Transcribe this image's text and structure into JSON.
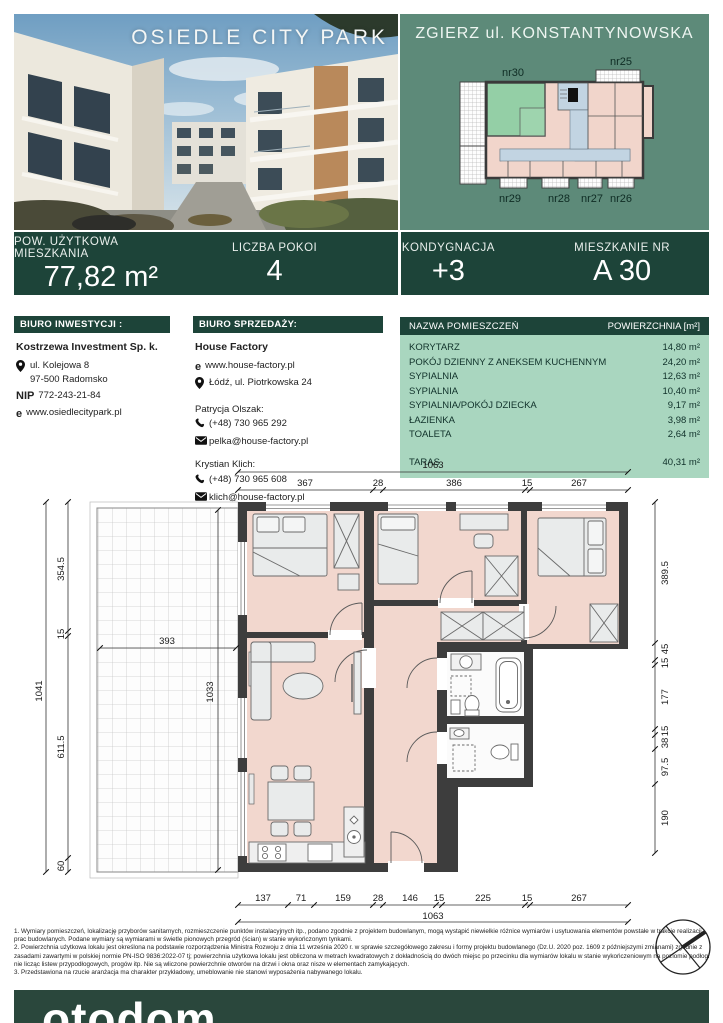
{
  "photo": {
    "title": "OSIEDLE CITY PARK"
  },
  "location": {
    "title": "ZGIERZ ul. KONSTANTYNOWSKA",
    "units": {
      "top_left": "nr30",
      "top_right": "nr25",
      "bottom": [
        "nr29",
        "nr28",
        "nr27",
        "nr26"
      ]
    }
  },
  "summary": {
    "cells": [
      {
        "label": "POW. UŻYTKOWA MIESZKANIA",
        "value": "77,82 m²"
      },
      {
        "label": "LICZBA POKOI",
        "value": "4"
      },
      {
        "label": "KONDYGNACJA",
        "value": "+3"
      },
      {
        "label": "MIESZKANIE NR",
        "value": "A 30"
      }
    ]
  },
  "investment_office": {
    "header": "BIURO INWESTYCJI :",
    "company": "Kostrzewa Investment Sp. k.",
    "address_line1": "ul. Kolejowa 8",
    "address_line2": "97-500 Radomsko",
    "nip_label": "NIP",
    "nip_value": "772-243-21-84",
    "web_prefix": "e",
    "website": "www.osiedlecitypark.pl"
  },
  "sales_office": {
    "header": "BIURO SPRZEDAŻY:",
    "company": "House Factory",
    "web_prefix": "e",
    "website": "www.house-factory.pl",
    "address": "Łódź, ul. Piotrkowska 24",
    "agents": [
      {
        "name": "Patrycja Olszak:",
        "phone": "(+48) 730 965 292",
        "email": "pelka@house-factory.pl"
      },
      {
        "name": "Krystian Klich:",
        "phone": "(+48) 730 965 608",
        "email": "klich@house-factory.pl"
      }
    ]
  },
  "rooms_table": {
    "header_name": "NAZWA POMIESZCZEŃ",
    "header_area": "POWIERZCHNIA [m²]",
    "rows": [
      {
        "name": "KORYTARZ",
        "area": "14,80 m²"
      },
      {
        "name": "POKÓJ DZIENNY Z ANEKSEM KUCHENNYM",
        "area": "24,20 m²"
      },
      {
        "name": "SYPIALNIA",
        "area": "12,63 m²"
      },
      {
        "name": "SYPIALNIA",
        "area": "10,40 m²"
      },
      {
        "name": "SYPIALNIA/POKÓJ DZIECKA",
        "area": "9,17 m²"
      },
      {
        "name": "ŁAZIENKA",
        "area": "3,98 m²"
      },
      {
        "name": "TOALETA",
        "area": "2,64 m²"
      }
    ],
    "taras": {
      "name": "TARAS",
      "area": "40,31 m²"
    }
  },
  "plan": {
    "dims": {
      "top_total": "1063",
      "top": [
        "367",
        "28",
        "386",
        "15",
        "267"
      ],
      "bottom": [
        "137",
        "71",
        "159",
        "28",
        "146",
        "15",
        "225",
        "15",
        "267"
      ],
      "bottom_total": "1063",
      "left_total": "1041",
      "left": [
        "354.5",
        "15",
        "611.5",
        "60"
      ],
      "right": [
        "389.5",
        "45",
        "15",
        "177",
        "15",
        "38",
        "97.5",
        "190"
      ],
      "terrace_width": "393",
      "terrace_height": "1033"
    }
  },
  "legal": {
    "notes": [
      "1. Wymiary pomieszczeń, lokalizację przyborów sanitarnych, rozmieszczenie punktów instalacyjnych itp., podano zgodnie z projektem budowlanym, mogą wystąpić niewielkie różnice wymiarów i usytuowania elementów powstałe w trakcie realizacji prac budowlanych. Podane wymiary są wymiarami w świetle pionowych przegród (ścian) w stanie wykończonym tynkami.",
      "2. Powierzchnia użytkowa lokalu jest określona na podstawie rozporządzenia Ministra Rozwoju z dnia 11 września 2020 r. w sprawie szczegółowego zakresu i formy projektu budowlanego (Dz.U. 2020 poz. 1609 z późniejszymi zmianami) zgodnie z zasadami zawartymi w polskiej normie PN-ISO 9836:2022-07 tj; powierzchnia użytkowa lokalu jest obliczona w metrach kwadratowych z dokładnością do dwóch miejsc po przecinku dla wymiarów lokalu w stanie wykończeniowym na poziomie podłogi nie licząc listew przypodłogowych, progów itp.  Nie są wliczone powierzchnie otworów na drzwi i okna oraz nisze w elementach zamykających.",
      "3. Przedstawiona na rzucie aranżacja ma charakter przykładowy, umeblowanie nie stanowi wyposażenia nabywanego lokalu."
    ]
  },
  "footer": {
    "logo": "otodom"
  },
  "colors": {
    "accent_dark_green": "#1d4439",
    "panel_green": "#5d8a79",
    "table_green": "#a9d6bf",
    "room_pink": "#f2d7ce",
    "corridor_blue": "#bfd3e0",
    "highlight_unit_green": "#94cfa6",
    "wall": "#3d3d3d"
  }
}
